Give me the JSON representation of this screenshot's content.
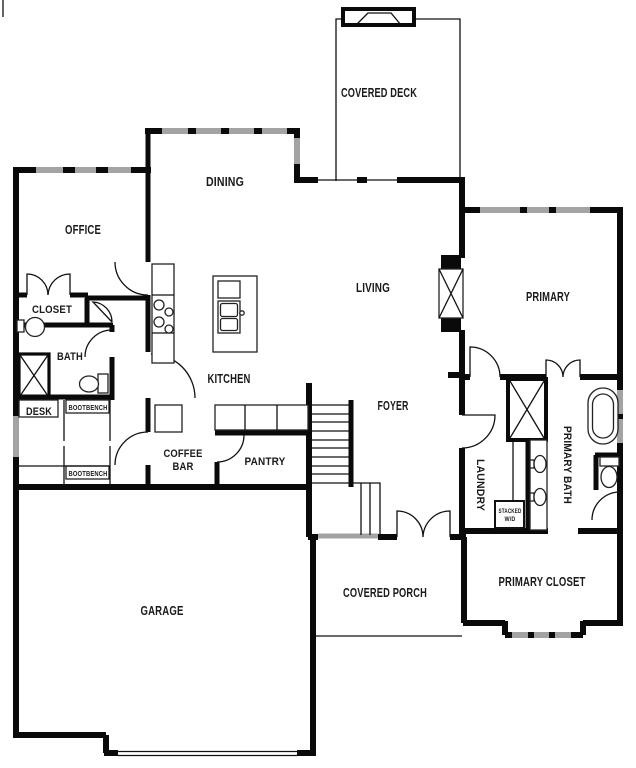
{
  "document": {
    "type": "residential-floor-plan",
    "background": "#ffffff"
  },
  "colors": {
    "wall": "#0a0a0a",
    "window": "#a3a3a3",
    "text": "#1a1a1a"
  },
  "rooms": {
    "covered_deck": "COVERED DECK",
    "dining": "DINING",
    "office": "OFFICE",
    "closet": "CLOSET",
    "bath": "BATH",
    "desk": "DESK",
    "bootbench": "BOOTBENCH",
    "kitchen": "KITCHEN",
    "living": "LIVING",
    "primary": "PRIMARY",
    "foyer": "FOYER",
    "coffee_bar_line1": "COFFEE",
    "coffee_bar_line2": "BAR",
    "pantry": "PANTRY",
    "laundry": "LAUNDRY",
    "stacked_wd_line1": "STACKED",
    "stacked_wd_line2": "W/D",
    "primary_bath": "PRIMARY BATH",
    "garage": "GARAGE",
    "covered_porch": "COVERED PORCH",
    "primary_closet": "PRIMARY CLOSET"
  }
}
